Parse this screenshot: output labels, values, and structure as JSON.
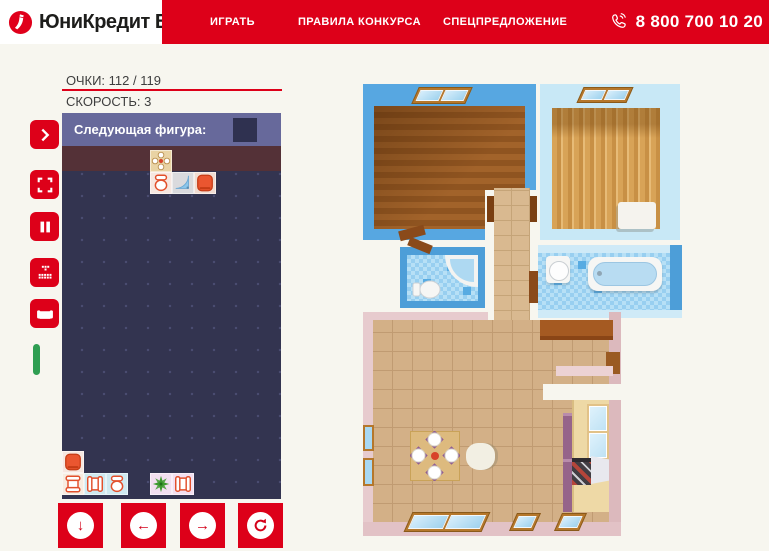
{
  "header": {
    "logo_text": "ЮниКредит Банк",
    "nav": [
      {
        "label": "ИГРАТЬ"
      },
      {
        "label": "ПРАВИЛА КОНКУРСА"
      },
      {
        "label": "СПЕЦПРЕДЛОЖЕНИЕ"
      }
    ],
    "phone": "8 800 700 10 20"
  },
  "game": {
    "score_label": "ОЧКИ:",
    "score_value": "112 / 119",
    "speed_label": "СКОРОСТЬ:",
    "speed_value": "3",
    "next_figure_label": "Следующая фигура:",
    "board": {
      "cols": 10,
      "tile_size": 22,
      "tiles": [
        {
          "icon": "table",
          "x": 88,
          "y": 37,
          "bg": "#e9d3a4"
        },
        {
          "icon": "toilet",
          "x": 88,
          "y": 59,
          "bg": "#f6e7e0"
        },
        {
          "icon": "shower",
          "x": 110,
          "y": 59,
          "bg": "#dadadd"
        },
        {
          "icon": "stool",
          "x": 132,
          "y": 59,
          "bg": "#f0dcd2"
        },
        {
          "icon": "stool",
          "x": 0,
          "y": 338,
          "bg": "#f6e7e0"
        },
        {
          "icon": "armchair",
          "x": 0,
          "y": 360,
          "bg": "#f7ece1"
        },
        {
          "icon": "chair",
          "x": 22,
          "y": 360,
          "bg": "#cfe9f0"
        },
        {
          "icon": "toilet",
          "x": 44,
          "y": 360,
          "bg": "#cfe9f0"
        },
        {
          "icon": "plant",
          "x": 88,
          "y": 360,
          "bg": "#f3dff0"
        },
        {
          "icon": "chair",
          "x": 110,
          "y": 360,
          "bg": "#f3dff0"
        }
      ]
    }
  },
  "sidebar": {
    "buttons": [
      {
        "icon": "chevron-right-icon"
      },
      {
        "icon": "fullscreen-icon"
      },
      {
        "icon": "pause-icon"
      },
      {
        "icon": "tetris-pieces-icon"
      },
      {
        "icon": "sofa-icon"
      }
    ],
    "indicator_color": "#2f9e52"
  },
  "controls": {
    "buttons": [
      {
        "icon": "arrow-down-icon"
      },
      {
        "icon": "arrow-left-icon"
      },
      {
        "icon": "arrow-right-icon"
      },
      {
        "icon": "rotate-icon"
      }
    ]
  },
  "colors": {
    "brand_red": "#dd0019",
    "board_navy": "#333450",
    "board_header_purple": "#67699b",
    "board_brown_row": "#543137",
    "green_indicator": "#2f9e52"
  }
}
